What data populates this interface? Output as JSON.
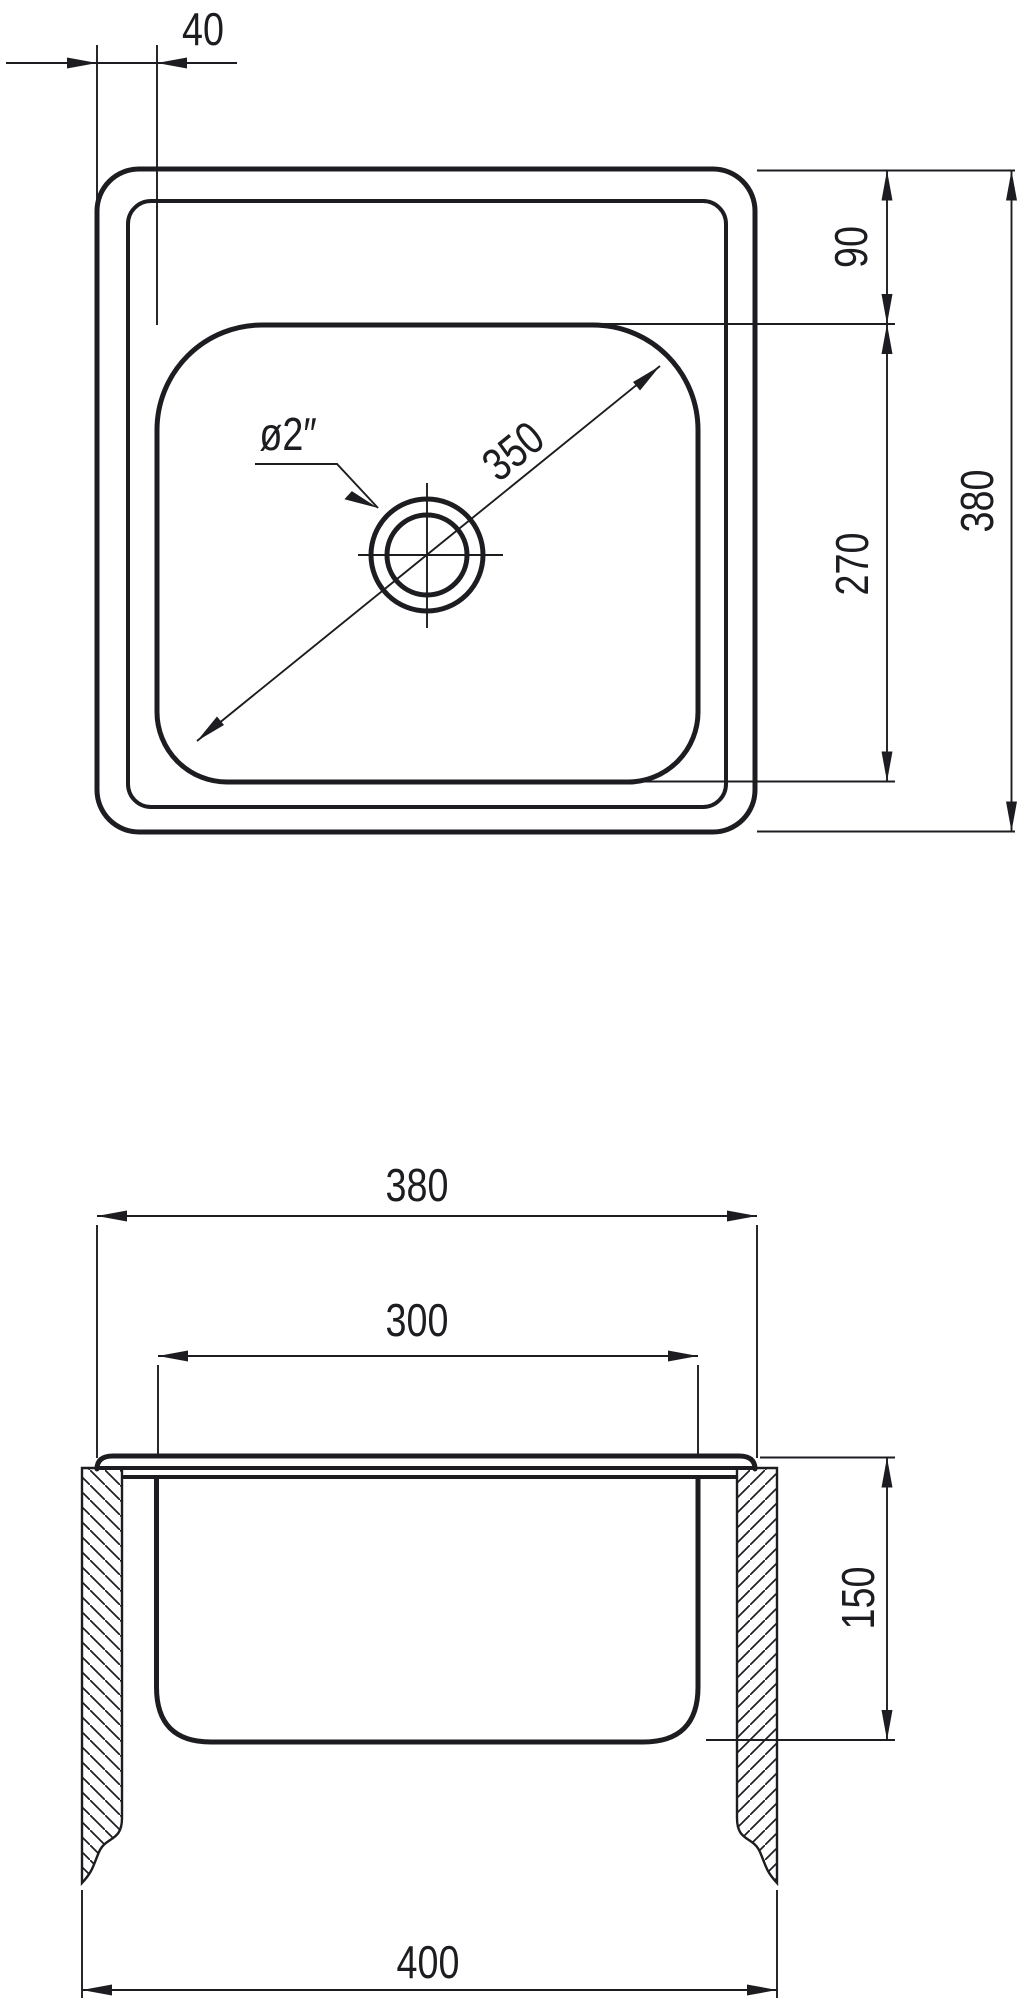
{
  "drawing": {
    "type": "technical-dimension-drawing",
    "views": [
      "plan-view",
      "section-view"
    ],
    "units_note": "",
    "colors": {
      "line": "#1d1d21",
      "background": "#ffffff"
    }
  },
  "labels": {
    "top": {
      "rim_offset": "40",
      "deck_top": "90",
      "basin_plan_depth": "270",
      "overall": "380",
      "diagonal": "350",
      "drain": "ø2″"
    },
    "section": {
      "overall": "380",
      "basin_width": "300",
      "basin_depth": "150",
      "stand_width": "400"
    }
  }
}
